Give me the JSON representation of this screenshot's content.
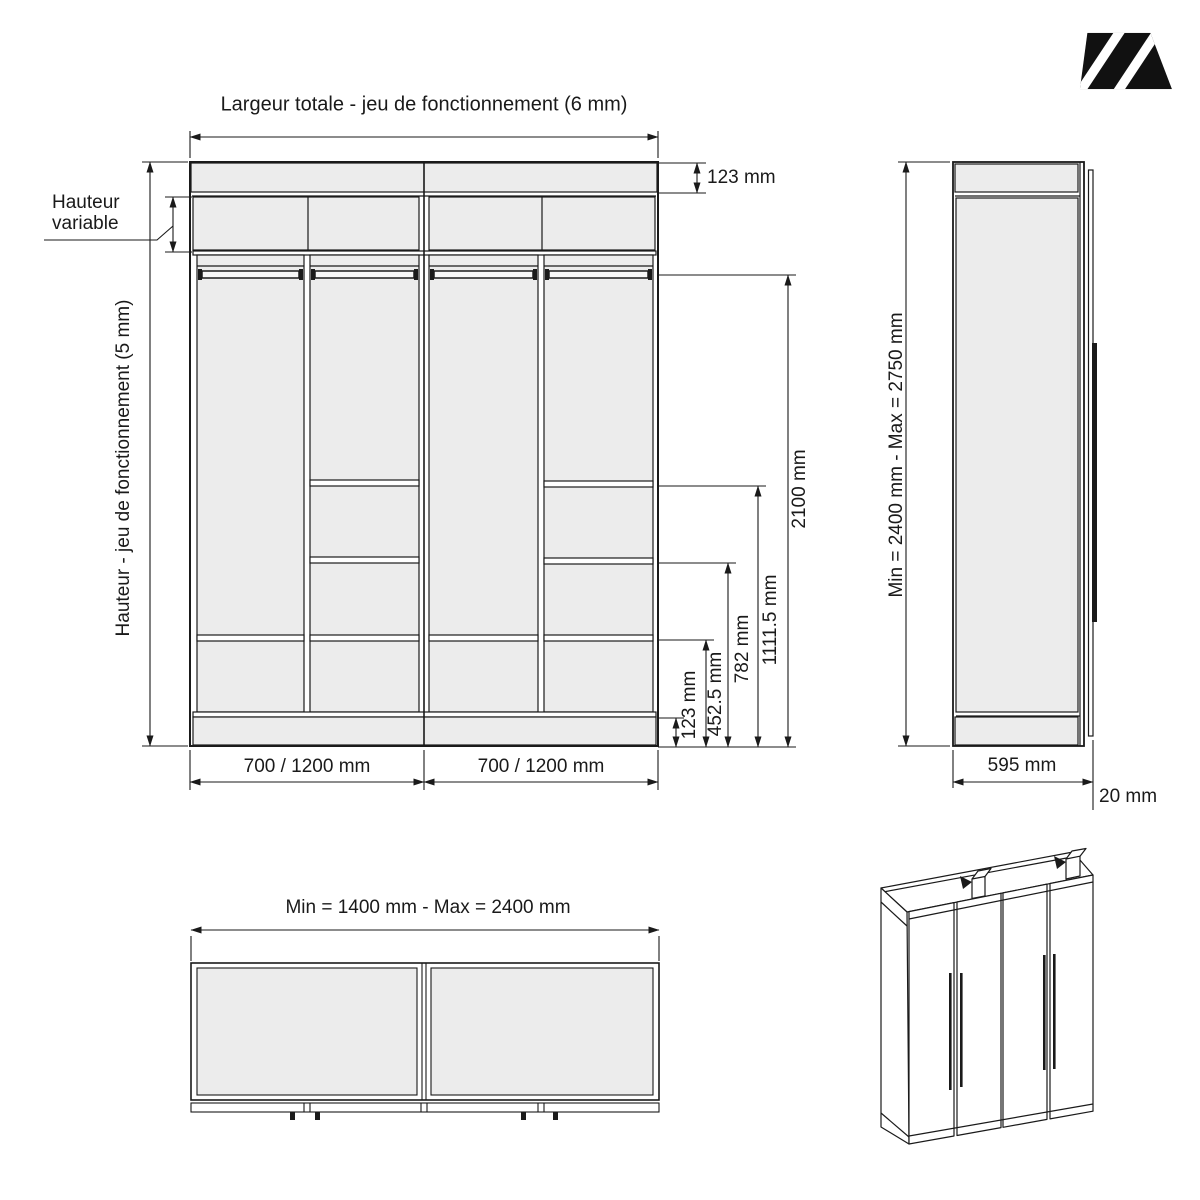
{
  "front_view": {
    "width_title": "Largeur totale - jeu de fonctionnement (6 mm)",
    "height_label": "Hauteur - jeu de fonctionnement (5 mm)",
    "hauteur_variable_line1": "Hauteur",
    "hauteur_variable_line2": "variable",
    "top_right_dim": "123 mm",
    "right_dims": {
      "d123": "123 mm",
      "d452": "452.5 mm",
      "d782": "782 mm",
      "d1111": "1111.5 mm",
      "d2100": "2100 mm"
    },
    "bottom_dim_left": "700 / 1200 mm",
    "bottom_dim_right": "700 / 1200 mm"
  },
  "side_view": {
    "height_label": "Min = 2400 mm - Max = 2750 mm",
    "depth_dim": "595 mm",
    "door_dim": "20 mm"
  },
  "top_view": {
    "width_label": "Min = 1400 mm - Max = 2400 mm"
  },
  "icons": {
    "brand_logo": "k-mark"
  },
  "colors": {
    "line": "#1a1a1a",
    "panel_fill": "#ececec",
    "logo": "#111111"
  }
}
